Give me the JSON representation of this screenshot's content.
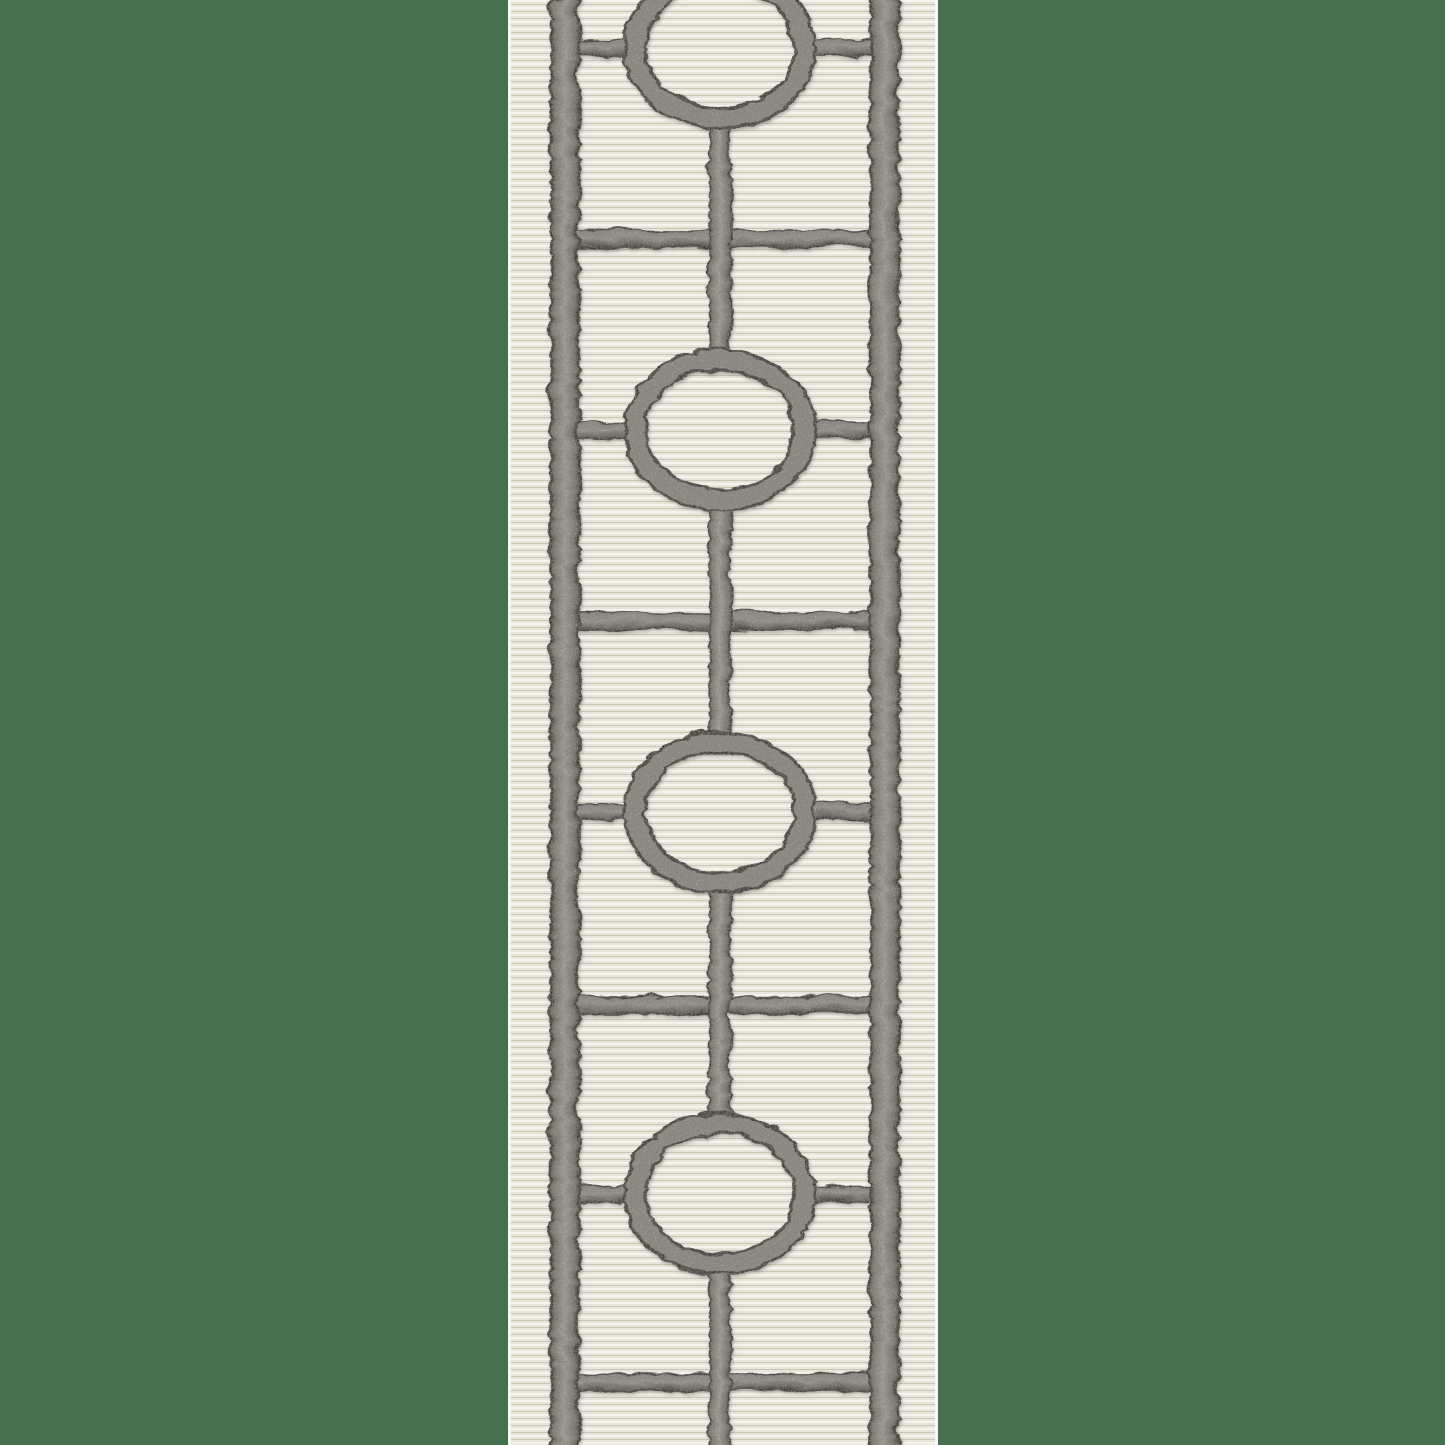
{
  "image": {
    "type": "product-photo",
    "subject": "Embroidered decorative tape trim with geometric circle-and-line lattice pattern on an ivory ribbed grosgrain ground",
    "background_color": "#47704f"
  },
  "tape": {
    "description": "Vertical strip of ivory ribbed fabric tape with charcoal-gray satin-stitch embroidery: two vertical border bands, a chain of rings linked by a center line, short side ticks at each ring and full crossbars between rings",
    "left": 508,
    "width": 430,
    "height": 1445,
    "fabric": {
      "rib_light": "#f4f3ed",
      "rib_mid": "#e8e6db",
      "rib_dark": "#c9c6b8",
      "rib_period": 7,
      "edge_highlight": "#fbfaf6"
    },
    "embroidery": {
      "thread_mid": "#8f8c86",
      "thread_light": "#a3a09a",
      "thread_dark": "#45423c",
      "thread_edge": "#3c3a35",
      "bands": [
        {
          "name": "left",
          "x": 41,
          "width": 28
        },
        {
          "name": "right",
          "x": 361,
          "width": 28
        }
      ],
      "connector": {
        "x": 199,
        "width": 22,
        "segments": [
          [
            119,
            355
          ],
          [
            501,
            737
          ],
          [
            883,
            1119
          ],
          [
            1265,
            1445
          ]
        ]
      },
      "circles": {
        "cx": 210,
        "centers_y": [
          46,
          428,
          810,
          1192
        ],
        "rx": 85,
        "ry": 70,
        "stroke": 23
      },
      "crossbars": {
        "x": 44,
        "width": 342,
        "centers_y": [
          237,
          619,
          1003,
          1380
        ],
        "thickness": 17
      },
      "ticks": {
        "thickness": 16,
        "left": {
          "x": 44,
          "width": 78
        },
        "right": {
          "x": 298,
          "width": 88
        }
      }
    }
  }
}
